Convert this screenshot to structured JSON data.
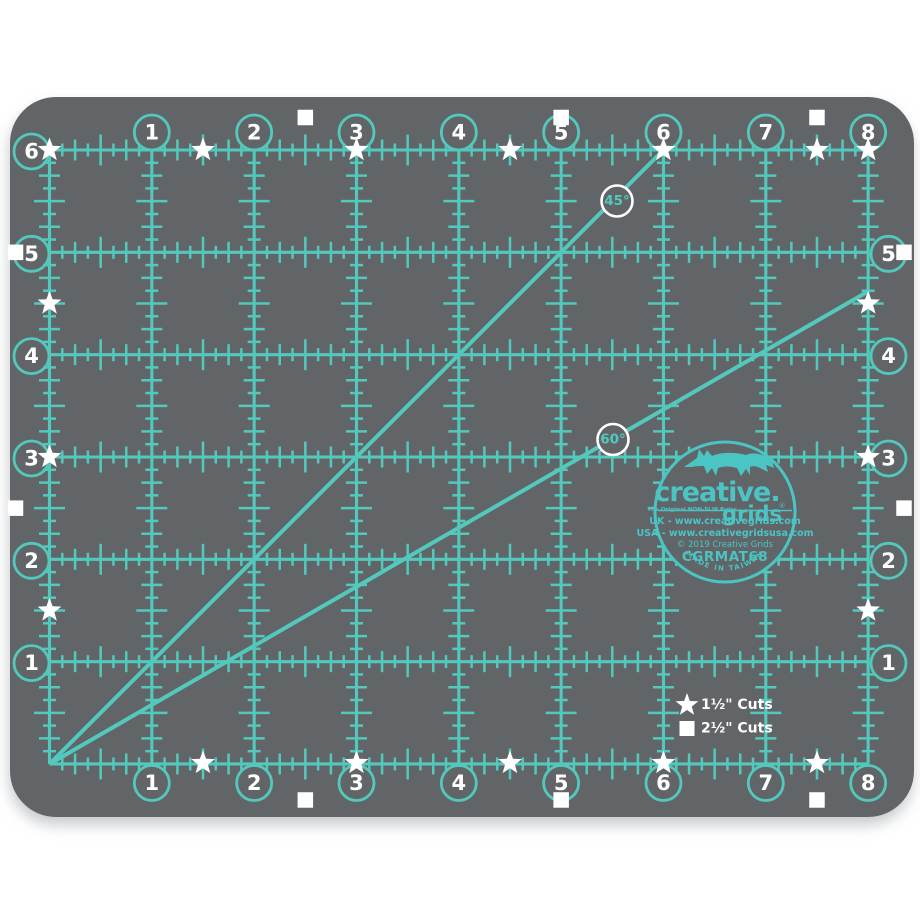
{
  "colors": {
    "background": "#ffffff",
    "mat": "#626568",
    "grid_teal": "#53c9bd",
    "logo_teal": "#4bc4c4",
    "marker_white": "#ffffff"
  },
  "grid": {
    "columns_in": 8,
    "rows_in": 6,
    "top_labels": [
      "1",
      "2",
      "3",
      "4",
      "5",
      "6",
      "7",
      "8"
    ],
    "bottom_labels": [
      "1",
      "2",
      "3",
      "4",
      "5",
      "6",
      "7",
      "8"
    ],
    "left_labels": [
      "6",
      "5",
      "4",
      "3",
      "2",
      "1"
    ],
    "right_labels": [
      "5",
      "4",
      "3",
      "2",
      "1"
    ]
  },
  "markers": {
    "stars": {
      "top": [
        0,
        1.5,
        3,
        4.5,
        6,
        7.5,
        8
      ],
      "bottom": [
        1.5,
        3,
        4.5,
        6,
        7.5
      ],
      "left": [
        1.5,
        3,
        4.5
      ],
      "right": [
        1.5,
        3,
        4.5
      ]
    },
    "squares": {
      "top": [
        2.5,
        5,
        7.5
      ],
      "bottom": [
        2.5,
        5,
        7.5
      ],
      "left": [
        1,
        3.5
      ],
      "right": [
        1,
        3.5
      ]
    }
  },
  "angles": [
    {
      "label": "45°"
    },
    {
      "label": "60°"
    }
  ],
  "legend": [
    {
      "symbol": "star",
      "label": "1½\" Cuts"
    },
    {
      "symbol": "square",
      "label": "2½\" Cuts"
    }
  ],
  "logo": {
    "brand_line1": "creative.",
    "brand_line2": "grids",
    "registered": "®",
    "tagline": "The Original NON-SLIP Ruler",
    "uk_line": "UK - www.creativegrids.com",
    "usa_line": "USA - www.creativegridsusa.com",
    "copyright_line": "© 2019 Creative Grids",
    "model": "CGRMAT68",
    "made_in": "MADE IN TAIWAN"
  }
}
